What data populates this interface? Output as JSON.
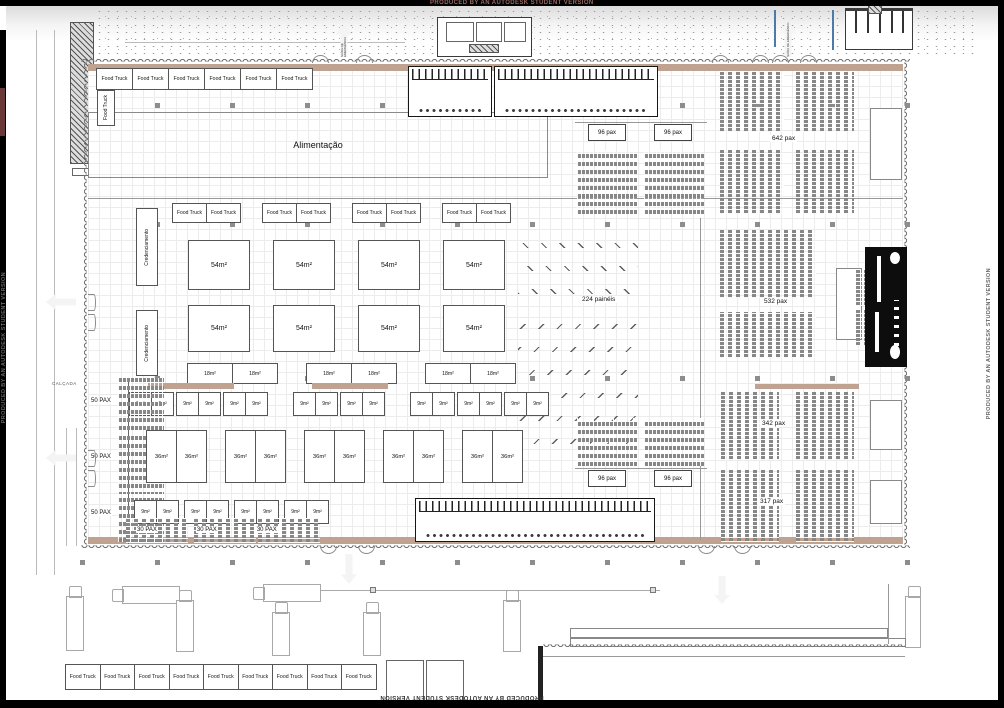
{
  "watermark": "PRODUCED BY AN AUTODESK STUDENT VERSION",
  "zones": {
    "alimentacao": "Alimentação",
    "credenciamento_a": "Credenciamento",
    "credenciamento_b": "Credenciamento",
    "paineis": "224 painéis",
    "calcada": "CALÇADA",
    "saida_emergencia": "SAÍDA DE EMERGÊNCIA",
    "food_truck_side": "Food Truck"
  },
  "food_trucks": {
    "top": [
      "Food Truck",
      "Food Truck",
      "Food Truck",
      "Food Truck",
      "Food Truck",
      "Food Truck"
    ],
    "middle": [
      "Food Truck",
      "Food Truck",
      "Food Truck",
      "Food Truck",
      "Food Truck",
      "Food Truck",
      "Food Truck",
      "Food Truck"
    ],
    "bottom": [
      "Food Truck",
      "Food Truck",
      "Food Truck",
      "Food Truck",
      "Food Truck",
      "Food Truck",
      "Food Truck",
      "Food Truck",
      "Food Truck"
    ]
  },
  "booths": {
    "row54_a": [
      "54m²",
      "54m²",
      "54m²",
      "54m²"
    ],
    "row54_b": [
      "54m²",
      "54m²",
      "54m²",
      "54m²"
    ],
    "row18": [
      "18m²",
      "18m²",
      "18m²",
      "18m²",
      "18m²",
      "18m²"
    ],
    "row9_a": [
      "9m²",
      "9m²",
      "9m²",
      "9m²",
      "9m²",
      "9m²",
      "9m²",
      "9m²",
      "9m²",
      "9m²",
      "9m²",
      "9m²",
      "9m²",
      "9m²",
      "9m²",
      "9m²"
    ],
    "row36": [
      "36m²",
      "36m²",
      "36m²",
      "36m²",
      "36m²",
      "36m²",
      "36m²",
      "36m²",
      "36m²",
      "36m²"
    ],
    "row9_b": [
      "9m²",
      "9m²",
      "9m²",
      "9m²",
      "9m²",
      "9m²",
      "9m²",
      "9m²"
    ]
  },
  "seating": {
    "labels96_top": [
      "96 pax",
      "96 pax"
    ],
    "labels96_bottom": [
      "96 pax",
      "96 pax"
    ],
    "label642": "642 pax",
    "label532": "532 pax",
    "label342": "342 pax",
    "label317": "317 pax",
    "labels50": [
      "50 PAX",
      "50 PAX",
      "50 PAX"
    ],
    "labels30": [
      "30 PAX",
      "30 PAX",
      "30 PAX"
    ]
  },
  "colors": {
    "tan": "#bfa28f",
    "stage": "#0d0d0d",
    "blue": "#4d7ba8",
    "watermark_red": "#9a6a62"
  }
}
